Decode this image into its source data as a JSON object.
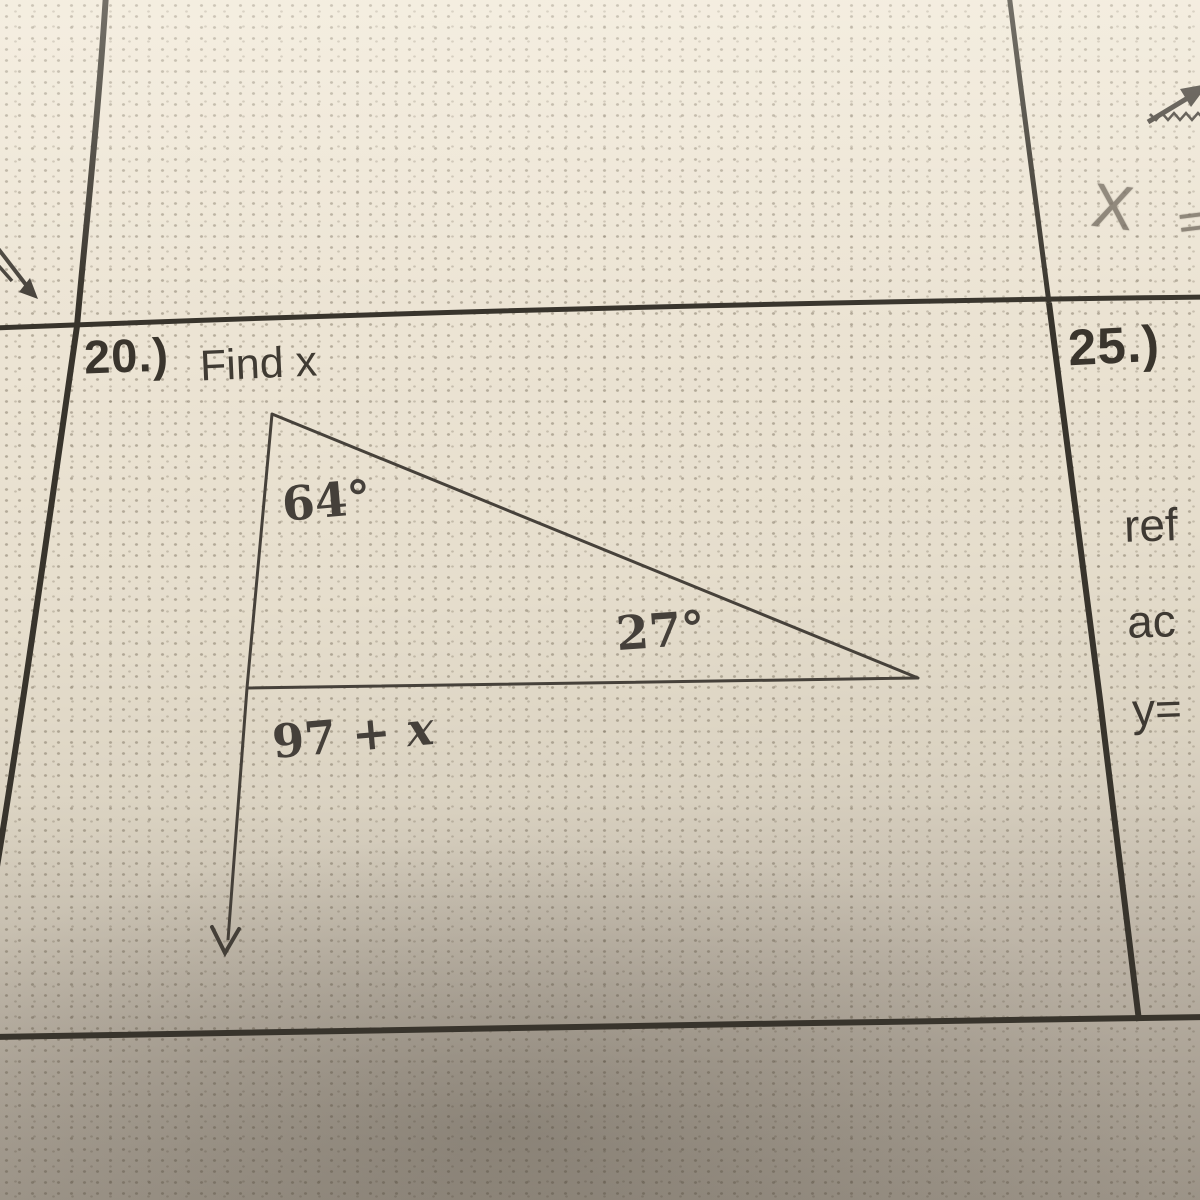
{
  "photo_type": "worksheet-photo",
  "problems": {
    "p20": {
      "number": "20.)",
      "title": "Find x",
      "figure": {
        "apex_angle": "64°",
        "base_angle": "27°",
        "exterior_prefix": "97 + ",
        "exterior_var": "x"
      }
    },
    "p25": {
      "number": "25.)",
      "lines": [
        "ref",
        "ac",
        "y="
      ]
    }
  },
  "handwriting": {
    "symbol": "X",
    "equals_fragment": "="
  },
  "colors": {
    "paper": "#ece4d4",
    "paper_shadow": "#b4ab9e",
    "ink": "#3c372f",
    "pencil": "#6e6559"
  }
}
